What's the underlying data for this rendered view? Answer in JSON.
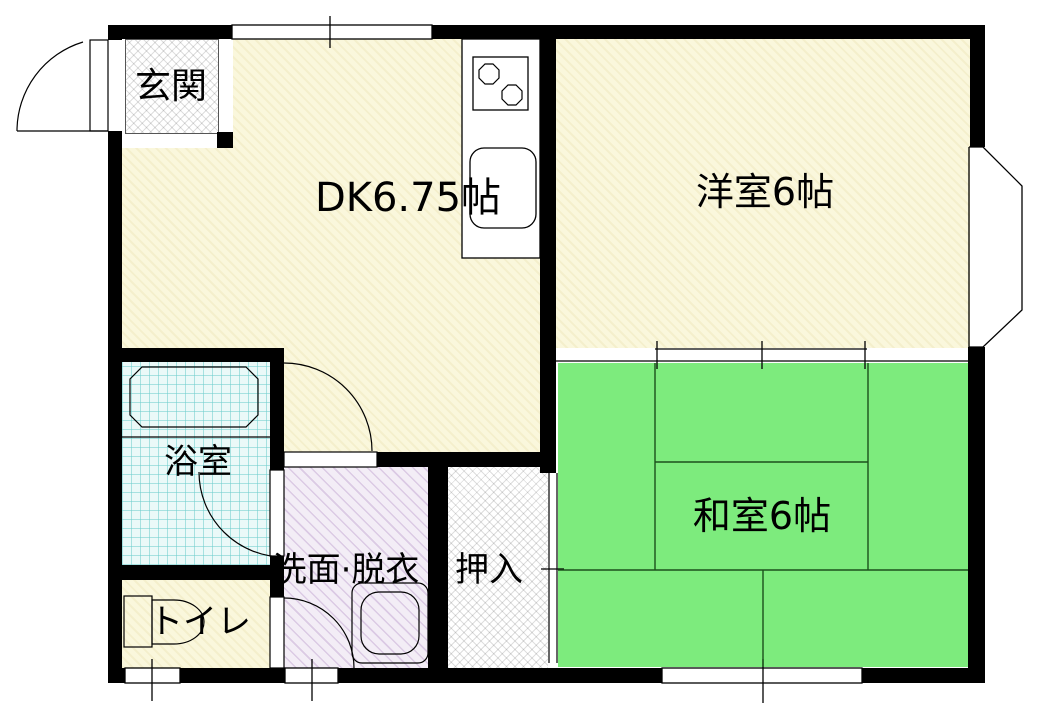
{
  "plan_title": "apartment-floor-plan",
  "rooms": {
    "genkan": {
      "label": "玄関"
    },
    "dk": {
      "label": "DK6.75帖"
    },
    "western": {
      "label": "洋室6帖"
    },
    "japanese": {
      "label": "和室6帖"
    },
    "bath": {
      "label": "浴室"
    },
    "toilet": {
      "label": "トイレ"
    },
    "washroom": {
      "label": "洗面·脱衣"
    },
    "closet": {
      "label": "押入"
    }
  },
  "colors": {
    "wall": "#000000",
    "wood_floor": "#FAF7DC",
    "tatami": "#7DEB7D",
    "bath_tile": "#EAF9F8",
    "washroom_floor": "#F3EDF6",
    "hatch_floor": "#FFFFFF",
    "line": "#000000",
    "background": "#FFFFFF"
  }
}
